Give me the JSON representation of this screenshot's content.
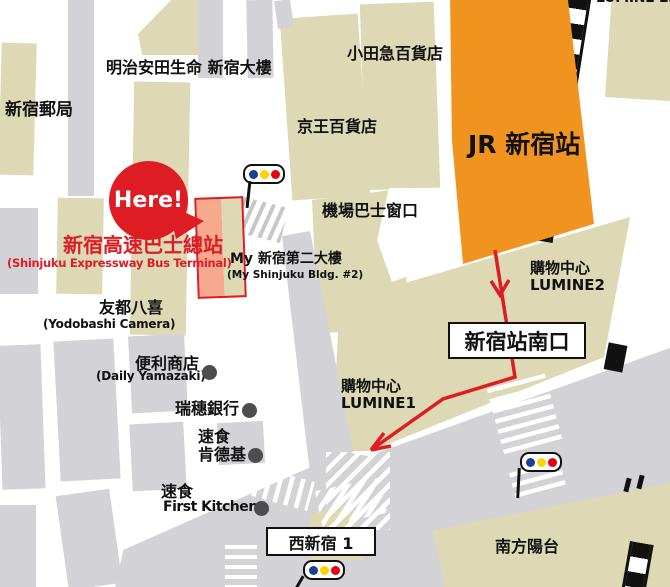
{
  "labels": {
    "lumine_est": "LUMINE EST",
    "post_office": "新宿郵局",
    "meiji_yasuda": "明治安田生命 新宿大樓",
    "odakyu": "小田急百貨店",
    "keio": "京王百貨店",
    "jr_station": "JR 新宿站",
    "airport_bus_counter": "機場巴士窗口",
    "my_bldg_line1": "My 新宿第二大樓",
    "my_bldg_line2": "(My Shinjuku Bldg. #2)",
    "terminal_line1": "新宿高速巴士總站",
    "terminal_line2": "(Shinjuku Expressway Bus Terminal)",
    "here": "Here!",
    "yodobashi_line1": "友都八喜",
    "yodobashi_line2": "(Yodobashi Camera)",
    "daily_line1": "便利商店",
    "daily_line2": "(Daily Yamazaki)",
    "mizuho": "瑞穗銀行",
    "kfc_line1": "速食",
    "kfc_line2": "肯德基",
    "first_kitchen_line1": "速食",
    "first_kitchen_line2": "First Kitchen",
    "lumine2_line1": "購物中心",
    "lumine2_line2": "LUMINE2",
    "south_exit": "新宿站南口",
    "lumine1_line1": "購物中心",
    "lumine1_line2": "LUMINE1",
    "nishi_shinjuku": "西新宿 1",
    "southern_terrace": "南方陽台"
  },
  "colors": {
    "building_beige": "#dcd9b4",
    "road_gray": "#d3d3d7",
    "station_orange": "#f0931f",
    "accent_red": "#dd1c24",
    "terminal_fill": "#f7a98e",
    "signal_blue": "#1c3f94",
    "signal_yellow": "#ffd300",
    "signal_red": "#e60012",
    "poi_marker_gray": "#4d4d4d",
    "rail_black": "#111111"
  }
}
